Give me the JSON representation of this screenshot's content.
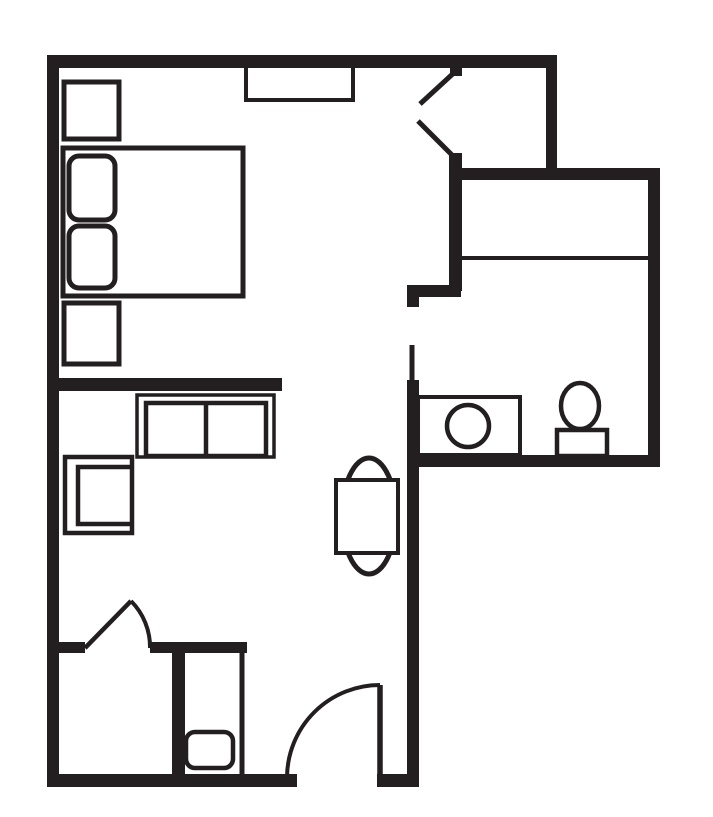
{
  "meta": {
    "title": "studio-room-floor-plan",
    "canvas": {
      "w": 713,
      "h": 817
    }
  },
  "colors": {
    "ink": "#231f20",
    "paper": "#ffffff"
  },
  "elements": [
    {
      "name": "window-shelf",
      "kind": "rect",
      "x": 246,
      "y": 60,
      "w": 107,
      "h": 40,
      "stroke": "ink",
      "sw": 4,
      "fill": "none"
    },
    {
      "name": "wall-top",
      "kind": "rect",
      "x": 47,
      "y": 55,
      "w": 510,
      "h": 13,
      "fill": "ink"
    },
    {
      "name": "wall-left",
      "kind": "rect",
      "x": 47,
      "y": 55,
      "w": 12,
      "h": 732,
      "fill": "ink"
    },
    {
      "name": "wall-bottom-left",
      "kind": "rect",
      "x": 47,
      "y": 774,
      "w": 250,
      "h": 13,
      "fill": "ink"
    },
    {
      "name": "wall-bottom-right-stub",
      "kind": "rect",
      "x": 377,
      "y": 774,
      "w": 42,
      "h": 13,
      "fill": "ink"
    },
    {
      "name": "wall-mid-vertical",
      "kind": "rect",
      "x": 407,
      "y": 380,
      "w": 12,
      "h": 407,
      "fill": "ink"
    },
    {
      "name": "wall-bath-jog",
      "kind": "rect",
      "x": 407,
      "y": 285,
      "w": 54,
      "h": 12,
      "fill": "ink"
    },
    {
      "name": "wall-bath-jog-stub",
      "kind": "rect",
      "x": 407,
      "y": 294,
      "w": 12,
      "h": 13,
      "fill": "ink"
    },
    {
      "name": "wall-bath-upper",
      "kind": "rect",
      "x": 449,
      "y": 153,
      "w": 13,
      "h": 138,
      "fill": "ink"
    },
    {
      "name": "wall-entry-cap",
      "kind": "rect",
      "x": 450,
      "y": 67,
      "w": 12,
      "h": 9,
      "fill": "ink"
    },
    {
      "name": "wall-vestibule-divider",
      "kind": "rect",
      "x": 546,
      "y": 67,
      "w": 11,
      "h": 101,
      "fill": "ink"
    },
    {
      "name": "wall-upper-horizontal",
      "kind": "rect",
      "x": 450,
      "y": 168,
      "w": 210,
      "h": 12,
      "fill": "ink"
    },
    {
      "name": "wall-right",
      "kind": "rect",
      "x": 648,
      "y": 168,
      "w": 12,
      "h": 299,
      "fill": "ink"
    },
    {
      "name": "wall-bath-bottom",
      "kind": "rect",
      "x": 418,
      "y": 455,
      "w": 242,
      "h": 12,
      "fill": "ink"
    },
    {
      "name": "wall-room-divider",
      "kind": "rect",
      "x": 52,
      "y": 378,
      "w": 230,
      "h": 13,
      "fill": "ink"
    },
    {
      "name": "wall-door-stub-left",
      "kind": "rect",
      "x": 52,
      "y": 642,
      "w": 33,
      "h": 11,
      "fill": "ink"
    },
    {
      "name": "wall-closet-top",
      "kind": "rect",
      "x": 150,
      "y": 642,
      "w": 97,
      "h": 11,
      "fill": "ink"
    },
    {
      "name": "wall-closet-left",
      "kind": "rect",
      "x": 172,
      "y": 642,
      "w": 13,
      "h": 132,
      "fill": "ink"
    },
    {
      "name": "closet-rod-line",
      "kind": "line",
      "x1": 458,
      "y1": 258,
      "x2": 648,
      "y2": 258,
      "stroke": "ink",
      "sw": 4
    },
    {
      "name": "bathroom-door-leaf",
      "kind": "line",
      "x1": 412,
      "y1": 345,
      "x2": 412,
      "y2": 382,
      "stroke": "ink",
      "sw": 5
    },
    {
      "name": "closet-front-line",
      "kind": "line",
      "x1": 242,
      "y1": 653,
      "x2": 242,
      "y2": 774,
      "stroke": "ink",
      "sw": 5
    },
    {
      "name": "entry-diagonal-upper",
      "kind": "line",
      "x1": 457,
      "y1": 70,
      "x2": 420,
      "y2": 104,
      "stroke": "ink",
      "sw": 5
    },
    {
      "name": "entry-diagonal-lower",
      "kind": "line",
      "x1": 418,
      "y1": 121,
      "x2": 456,
      "y2": 159,
      "stroke": "ink",
      "sw": 5
    },
    {
      "name": "interior-door-leaf",
      "kind": "line",
      "x1": 85,
      "y1": 648,
      "x2": 131,
      "y2": 601,
      "stroke": "ink",
      "sw": 4.5
    },
    {
      "name": "interior-door-arc",
      "kind": "path",
      "d": "M131,601 A65,65 0 0 1 150,648",
      "stroke": "ink",
      "sw": 4,
      "fill": "none"
    },
    {
      "name": "entry-door-leaf",
      "kind": "line",
      "x1": 380,
      "y1": 685,
      "x2": 380,
      "y2": 777,
      "stroke": "ink",
      "sw": 5.5
    },
    {
      "name": "entry-door-arc",
      "kind": "path",
      "d": "M380,685 A93,93 0 0 0 287,777",
      "stroke": "ink",
      "sw": 4,
      "fill": "none"
    },
    {
      "name": "nightstand-top",
      "kind": "rect",
      "x": 64,
      "y": 82,
      "w": 55,
      "h": 57,
      "stroke": "ink",
      "sw": 5,
      "fill": "paper"
    },
    {
      "name": "bed",
      "kind": "rect",
      "x": 63,
      "y": 148,
      "w": 180,
      "h": 148,
      "stroke": "ink",
      "sw": 5,
      "fill": "paper"
    },
    {
      "name": "pillow-top",
      "kind": "rect",
      "x": 69,
      "y": 156,
      "w": 46,
      "h": 64,
      "r": 10,
      "stroke": "ink",
      "sw": 5,
      "fill": "paper"
    },
    {
      "name": "pillow-bottom",
      "kind": "rect",
      "x": 69,
      "y": 226,
      "w": 46,
      "h": 62,
      "r": 10,
      "stroke": "ink",
      "sw": 5,
      "fill": "paper"
    },
    {
      "name": "nightstand-bottom",
      "kind": "rect",
      "x": 64,
      "y": 303,
      "w": 55,
      "h": 61,
      "stroke": "ink",
      "sw": 5,
      "fill": "paper"
    },
    {
      "name": "sofa-outer",
      "kind": "rect",
      "x": 137,
      "y": 395,
      "w": 137,
      "h": 62,
      "stroke": "ink",
      "sw": 3.5,
      "fill": "paper"
    },
    {
      "name": "sofa-seats",
      "kind": "rect",
      "x": 146,
      "y": 403,
      "w": 120,
      "h": 53,
      "stroke": "ink",
      "sw": 4.5,
      "fill": "paper"
    },
    {
      "name": "sofa-seat-divider",
      "kind": "line",
      "x1": 206,
      "y1": 403,
      "x2": 206,
      "y2": 456,
      "stroke": "ink",
      "sw": 4.5
    },
    {
      "name": "armchair-outer",
      "kind": "rect",
      "x": 65,
      "y": 457,
      "w": 67,
      "h": 76,
      "stroke": "ink",
      "sw": 4.5,
      "fill": "paper"
    },
    {
      "name": "armchair-seat",
      "kind": "path",
      "d": "M130,467 L78,467 L78,524 L130,524",
      "stroke": "ink",
      "sw": 4.5,
      "fill": "none"
    },
    {
      "name": "table-chairs-ellipse",
      "kind": "ellipse",
      "cx": 369,
      "cy": 516,
      "rx": 27,
      "ry": 58,
      "stroke": "ink",
      "sw": 5,
      "fill": "paper"
    },
    {
      "name": "table-top",
      "kind": "rect",
      "x": 336,
      "y": 480,
      "w": 62,
      "h": 73,
      "stroke": "ink",
      "sw": 4,
      "fill": "paper"
    },
    {
      "name": "sink-counter",
      "kind": "rect",
      "x": 418,
      "y": 397,
      "w": 102,
      "h": 58,
      "stroke": "ink",
      "sw": 4,
      "fill": "paper"
    },
    {
      "name": "sink-basin",
      "kind": "circle",
      "cx": 468,
      "cy": 426,
      "r": 21,
      "stroke": "ink",
      "sw": 4.5,
      "fill": "paper"
    },
    {
      "name": "toilet-tank",
      "kind": "rect",
      "x": 557,
      "y": 430,
      "w": 50,
      "h": 26,
      "stroke": "ink",
      "sw": 4.5,
      "fill": "paper"
    },
    {
      "name": "toilet-bowl",
      "kind": "ellipse",
      "cx": 580,
      "cy": 406,
      "rx": 19,
      "ry": 23,
      "stroke": "ink",
      "sw": 4.5,
      "fill": "paper"
    },
    {
      "name": "closet-safe",
      "kind": "rect",
      "x": 186,
      "y": 732,
      "w": 47,
      "h": 36,
      "r": 9,
      "stroke": "ink",
      "sw": 4.5,
      "fill": "paper"
    }
  ]
}
